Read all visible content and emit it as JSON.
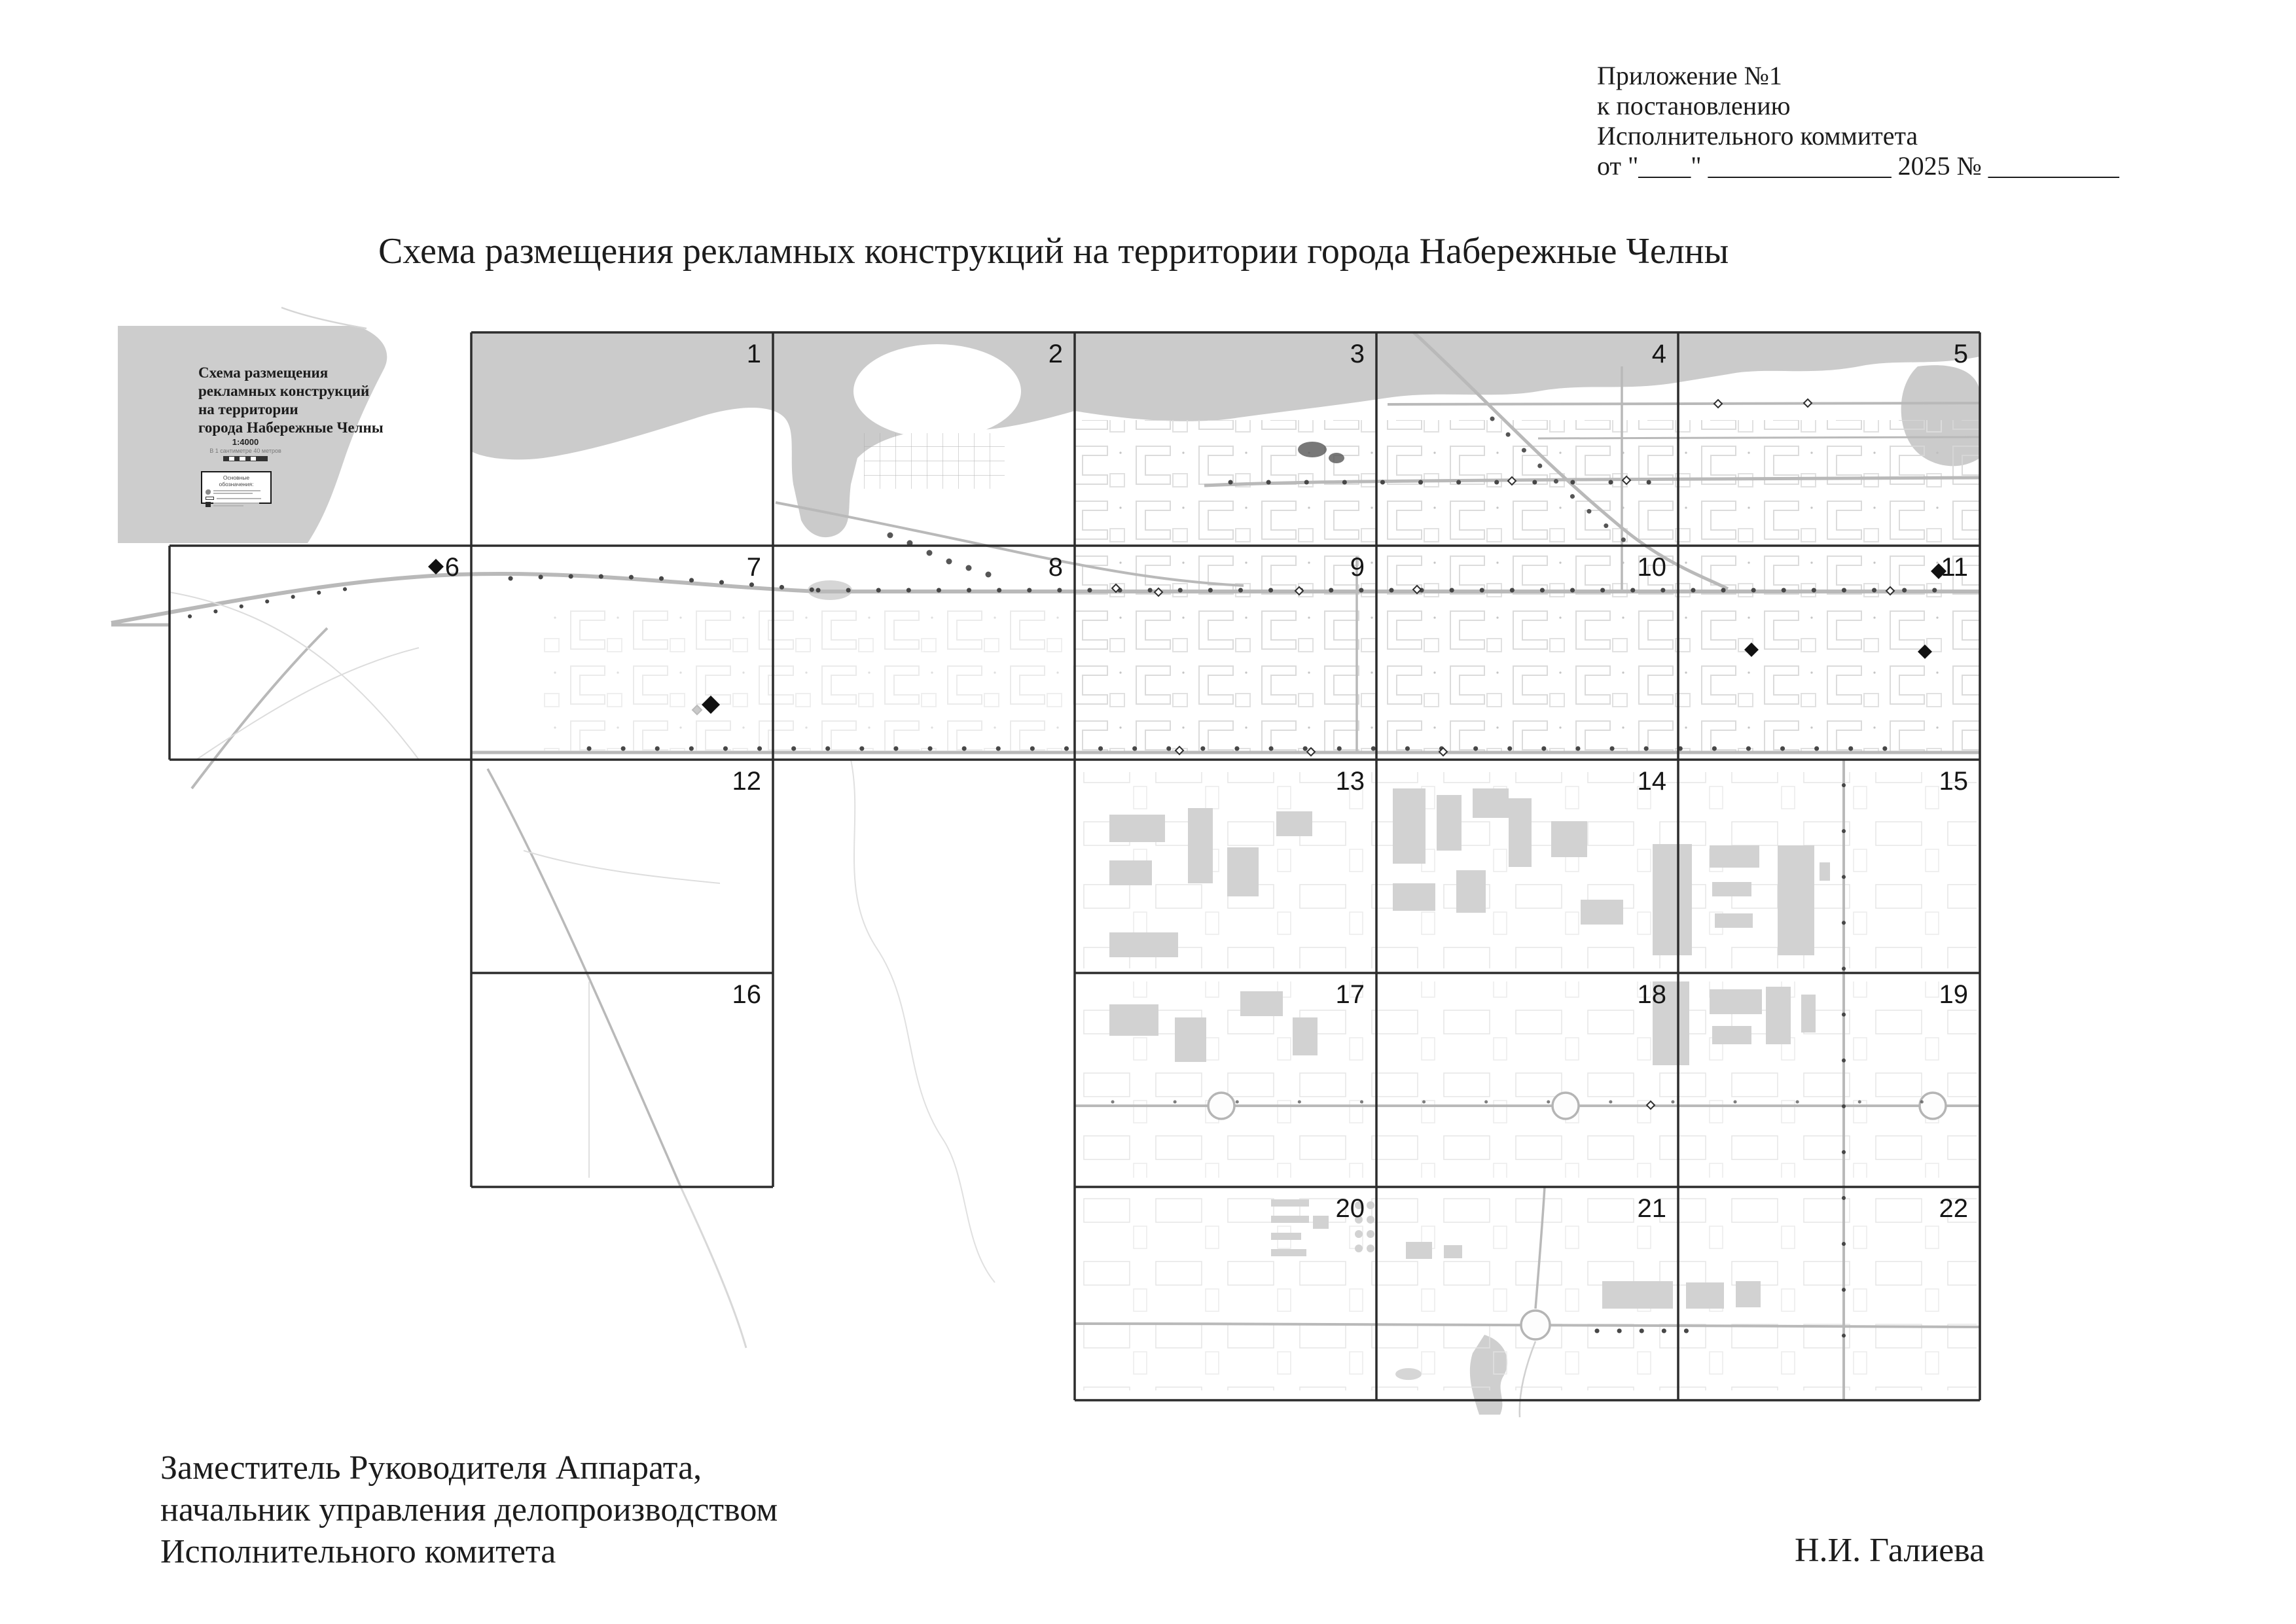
{
  "header": {
    "lines": [
      "Приложение №1",
      "к постановлению",
      "Исполнительного коммитета",
      "от \"____\"  ______________ 2025 № __________"
    ]
  },
  "title": "Схема размещения рекламных конструкций на территории города Набережные Челны",
  "map": {
    "legend": {
      "title_lines": [
        "Схема размещения",
        "рекламных конструкций",
        "на территории",
        "города Набережные Челны"
      ],
      "scale": "1:4000",
      "scale_note": "В 1 сантиметре 40 метров",
      "symbols_title": "Основные обозначения:"
    },
    "grid_cells": [
      "1",
      "2",
      "3",
      "4",
      "5",
      "6",
      "7",
      "8",
      "9",
      "10",
      "11",
      "12",
      "13",
      "14",
      "15",
      "16",
      "17",
      "18",
      "19",
      "20",
      "21",
      "22"
    ],
    "marker_legend_name": "ad-structure-diamond"
  },
  "signature": {
    "lines": [
      "Заместитель Руководителя Аппарата,",
      "начальник управления делопроизводством",
      "Исполнительного комитета"
    ],
    "name": "Н.И. Галиева"
  }
}
